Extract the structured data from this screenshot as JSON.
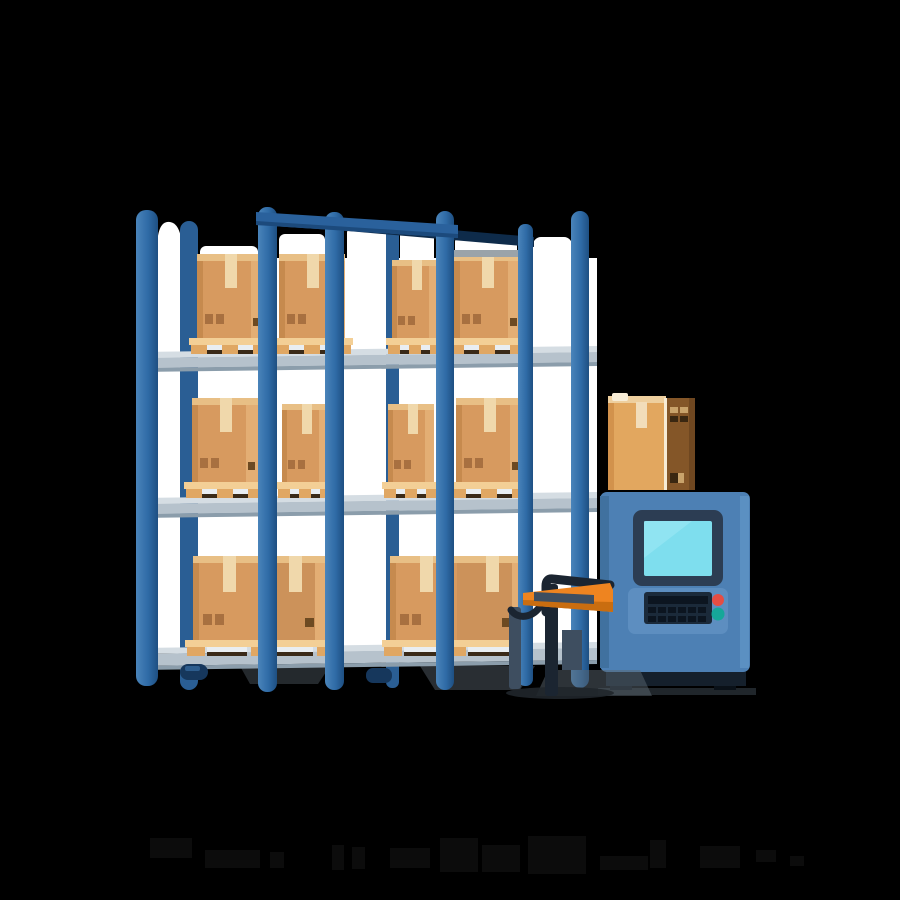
{
  "scene": {
    "type": "flat vector illustration",
    "subject": "warehouse pallet racking with cardboard boxes on pallets, a blue control terminal kiosk with a carton on top, and a pallet jack",
    "background": "#000000",
    "canvas": {
      "width": 900,
      "height": 900
    }
  },
  "rack": {
    "shelves": 3,
    "front_posts": 6,
    "back_posts": 2,
    "bays": 2,
    "boxes_per_level": [
      4,
      4,
      2
    ],
    "pallet_count": 10,
    "backdrop": "white panels behind each bay"
  },
  "kiosk": {
    "display": "blank cyan screen",
    "keypad_keys": 12,
    "buttons": [
      {
        "name": "red-button",
        "color": "#E64D43"
      },
      {
        "name": "teal-button",
        "color": "#16A799"
      }
    ],
    "carton_on_top": true
  },
  "pallet_jack": {
    "body_color": "#EE8420",
    "handle_color": "#1B2531"
  },
  "colors": {
    "bg": "#000000",
    "backdrop": "#FFFFFF",
    "postLight": "#4A84BA",
    "postMid": "#2F6BA6",
    "postDark": "#1E4F82",
    "postBack": "#2A5E94",
    "beamFront": "#2A619C",
    "beamUnder": "#1C4A7C",
    "beamBack": "#0E2B4A",
    "shelfTop": "#D5DDE3",
    "shelfFace": "#B6C2CC",
    "shelfEdge": "#8B9DAB",
    "boxLeftEdge": "#C68A4E",
    "boxFace": "#D79A5F",
    "boxSide": "#E3AE74",
    "boxFlap": "#E8BF85",
    "boxTape": "#F0D8AB",
    "boxLabel": "#A87040",
    "boxMark": "#6D4A22",
    "boxGrayTop": "#9AA3A9",
    "palletPlank": "#F3CF96",
    "palletBlock": "#E0A763",
    "palletSlotLight": "#E9EEF2",
    "palletSlotDark": "#3A2A18",
    "machineBody": "#4D80B4",
    "machineLeft": "#40719F",
    "machineRight": "#5B90C2",
    "machinePanel": "#5D8EC0",
    "bezel": "#2C3D53",
    "screen": "#7EDEEE",
    "screenSheen": "#A7ECF6",
    "keyPlate": "#1B2A3A",
    "key": "#0C1520",
    "btnRed": "#E64D43",
    "btnTeal": "#16A799",
    "base": "#15202C",
    "baseDark": "#0A1118",
    "cartonFront": "#E2A75F",
    "cartonLeft": "#D2924C",
    "cartonTop": "#EECF9E",
    "cartonTopHi": "#F7ECD6",
    "cartonTape": "#F2DDBA",
    "cartonSide": "#845628",
    "cartonSideDark": "#6F4720",
    "cartonGlyphLight": "#C9A36B",
    "cartonGlyphDark": "#3A2711",
    "jackDark": "#1B2531",
    "jackSlate": "#3E4E60",
    "jackOrange": "#EE8420",
    "jackOrangeDark": "#C96D10",
    "shadowSoft": "#5A6670",
    "shadowDeep": "#20262B",
    "casterBlue": "#16375C",
    "casterHi": "#2D5D8E",
    "watermark": "#0C0C0C"
  }
}
